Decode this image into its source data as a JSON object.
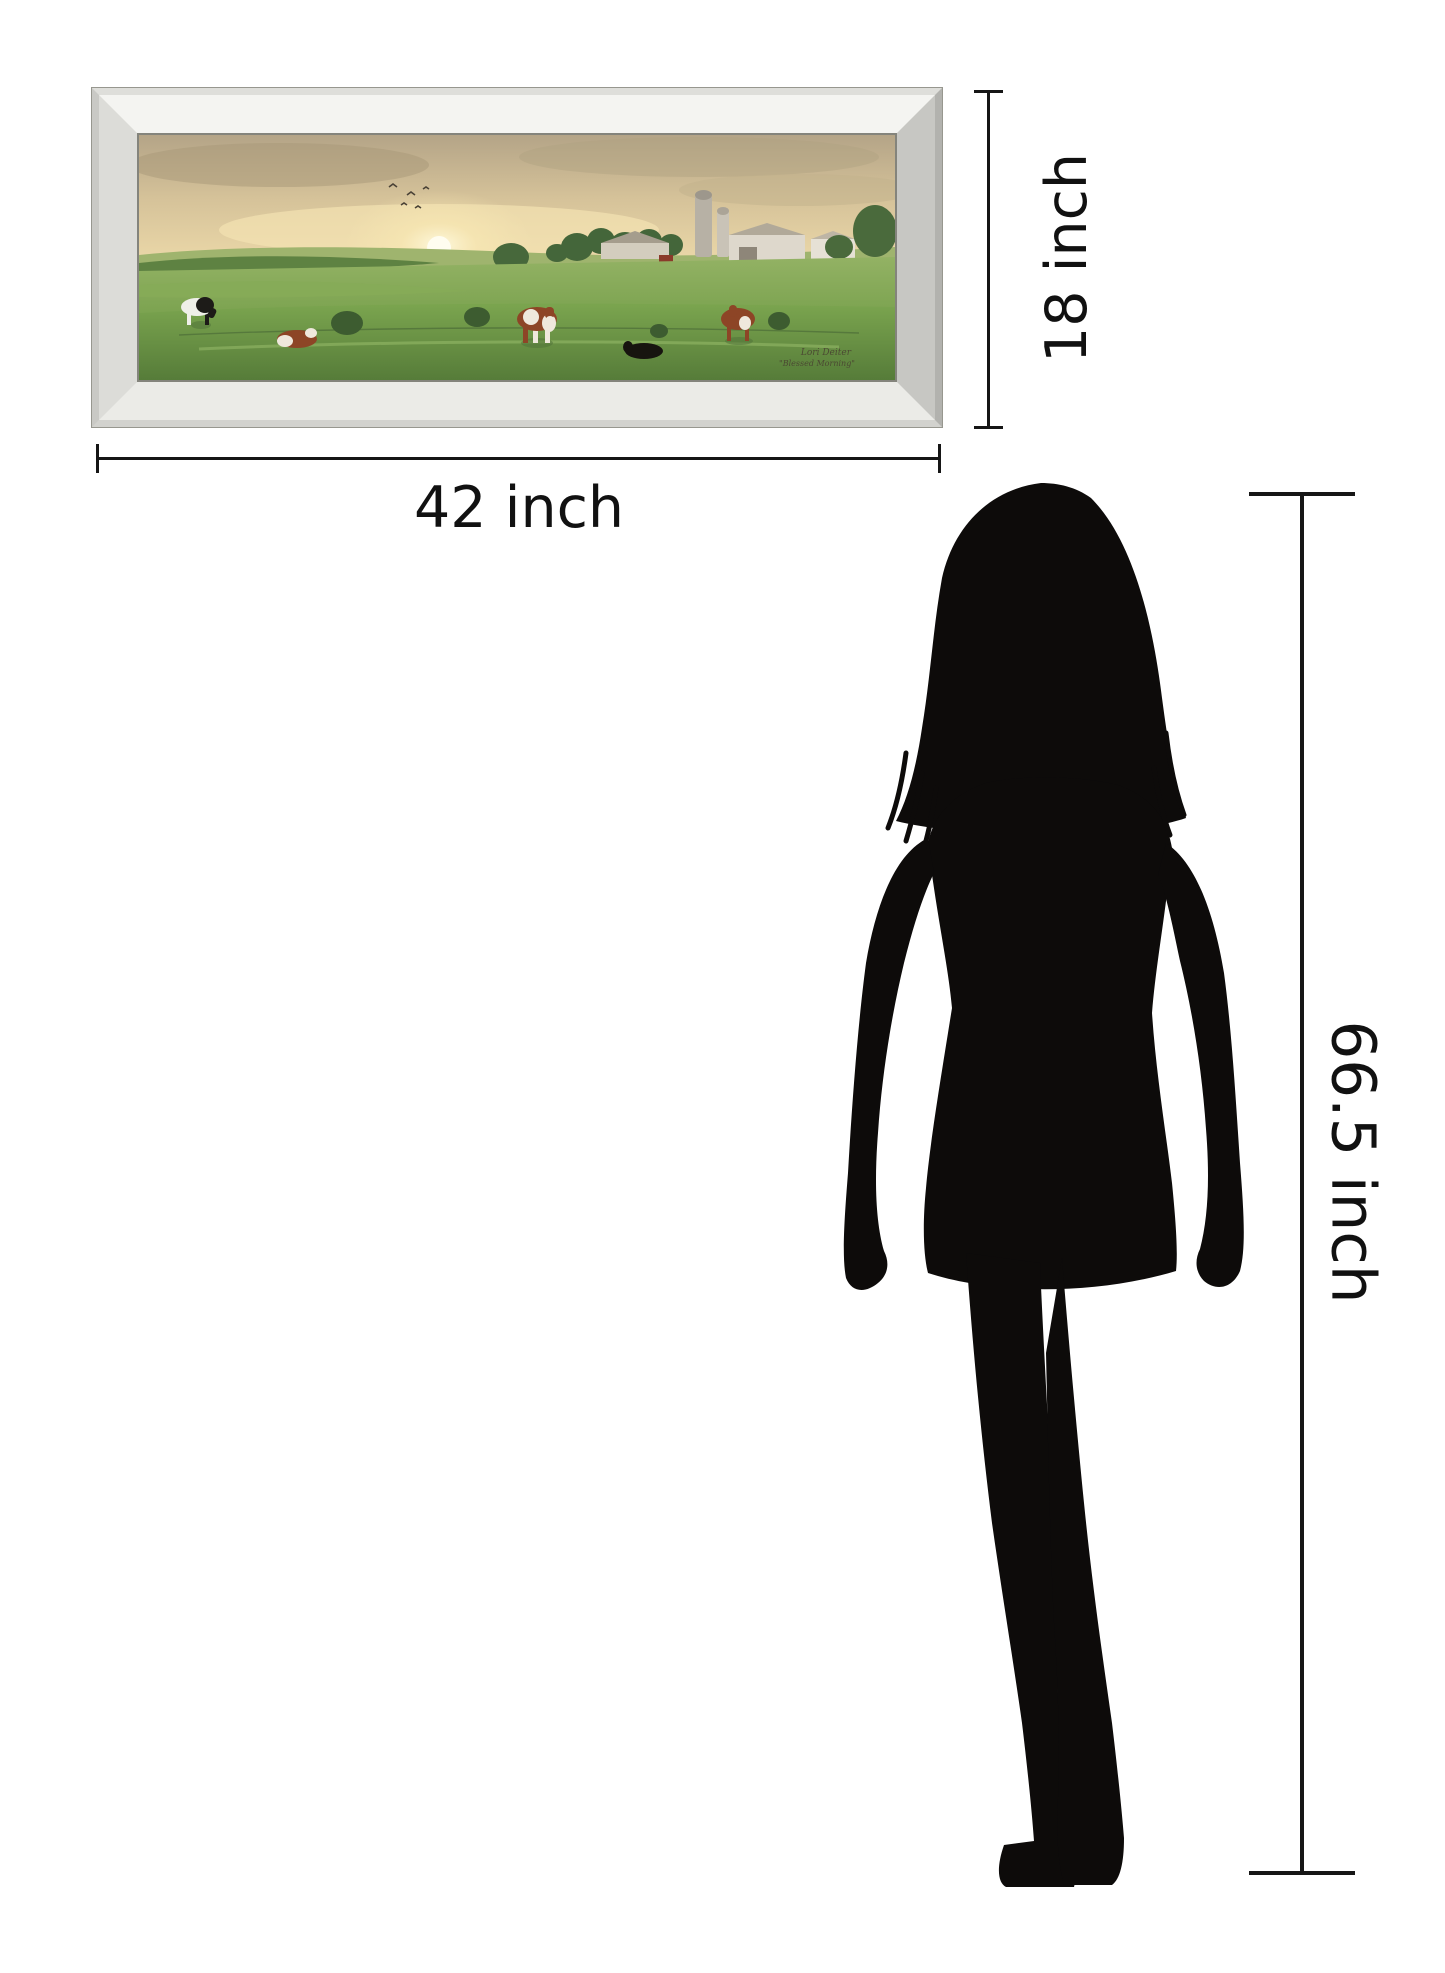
{
  "artwork": {
    "artist_signature": "Lori Deiter",
    "title_signature": "\"Blessed Morning\"",
    "scene": "farm pasture with cows at sunrise, barn and silo"
  },
  "dimensions": {
    "frame_width_label": "42 inch",
    "frame_height_label": "18 inch",
    "person_height_label": "66.5 inch"
  },
  "colors": {
    "background": "#ffffff",
    "dimension_line": "#161616",
    "silhouette_black": "#0d0b0a",
    "frame_silver": "#e8e8e4",
    "sky_warm": "#d8c59b",
    "sun_glow": "#fff6d7",
    "grass_green": "#7aa04b"
  },
  "icons": {
    "person": "woman-silhouette",
    "sun": "sun-glow",
    "cows": "cow-silhouettes"
  }
}
